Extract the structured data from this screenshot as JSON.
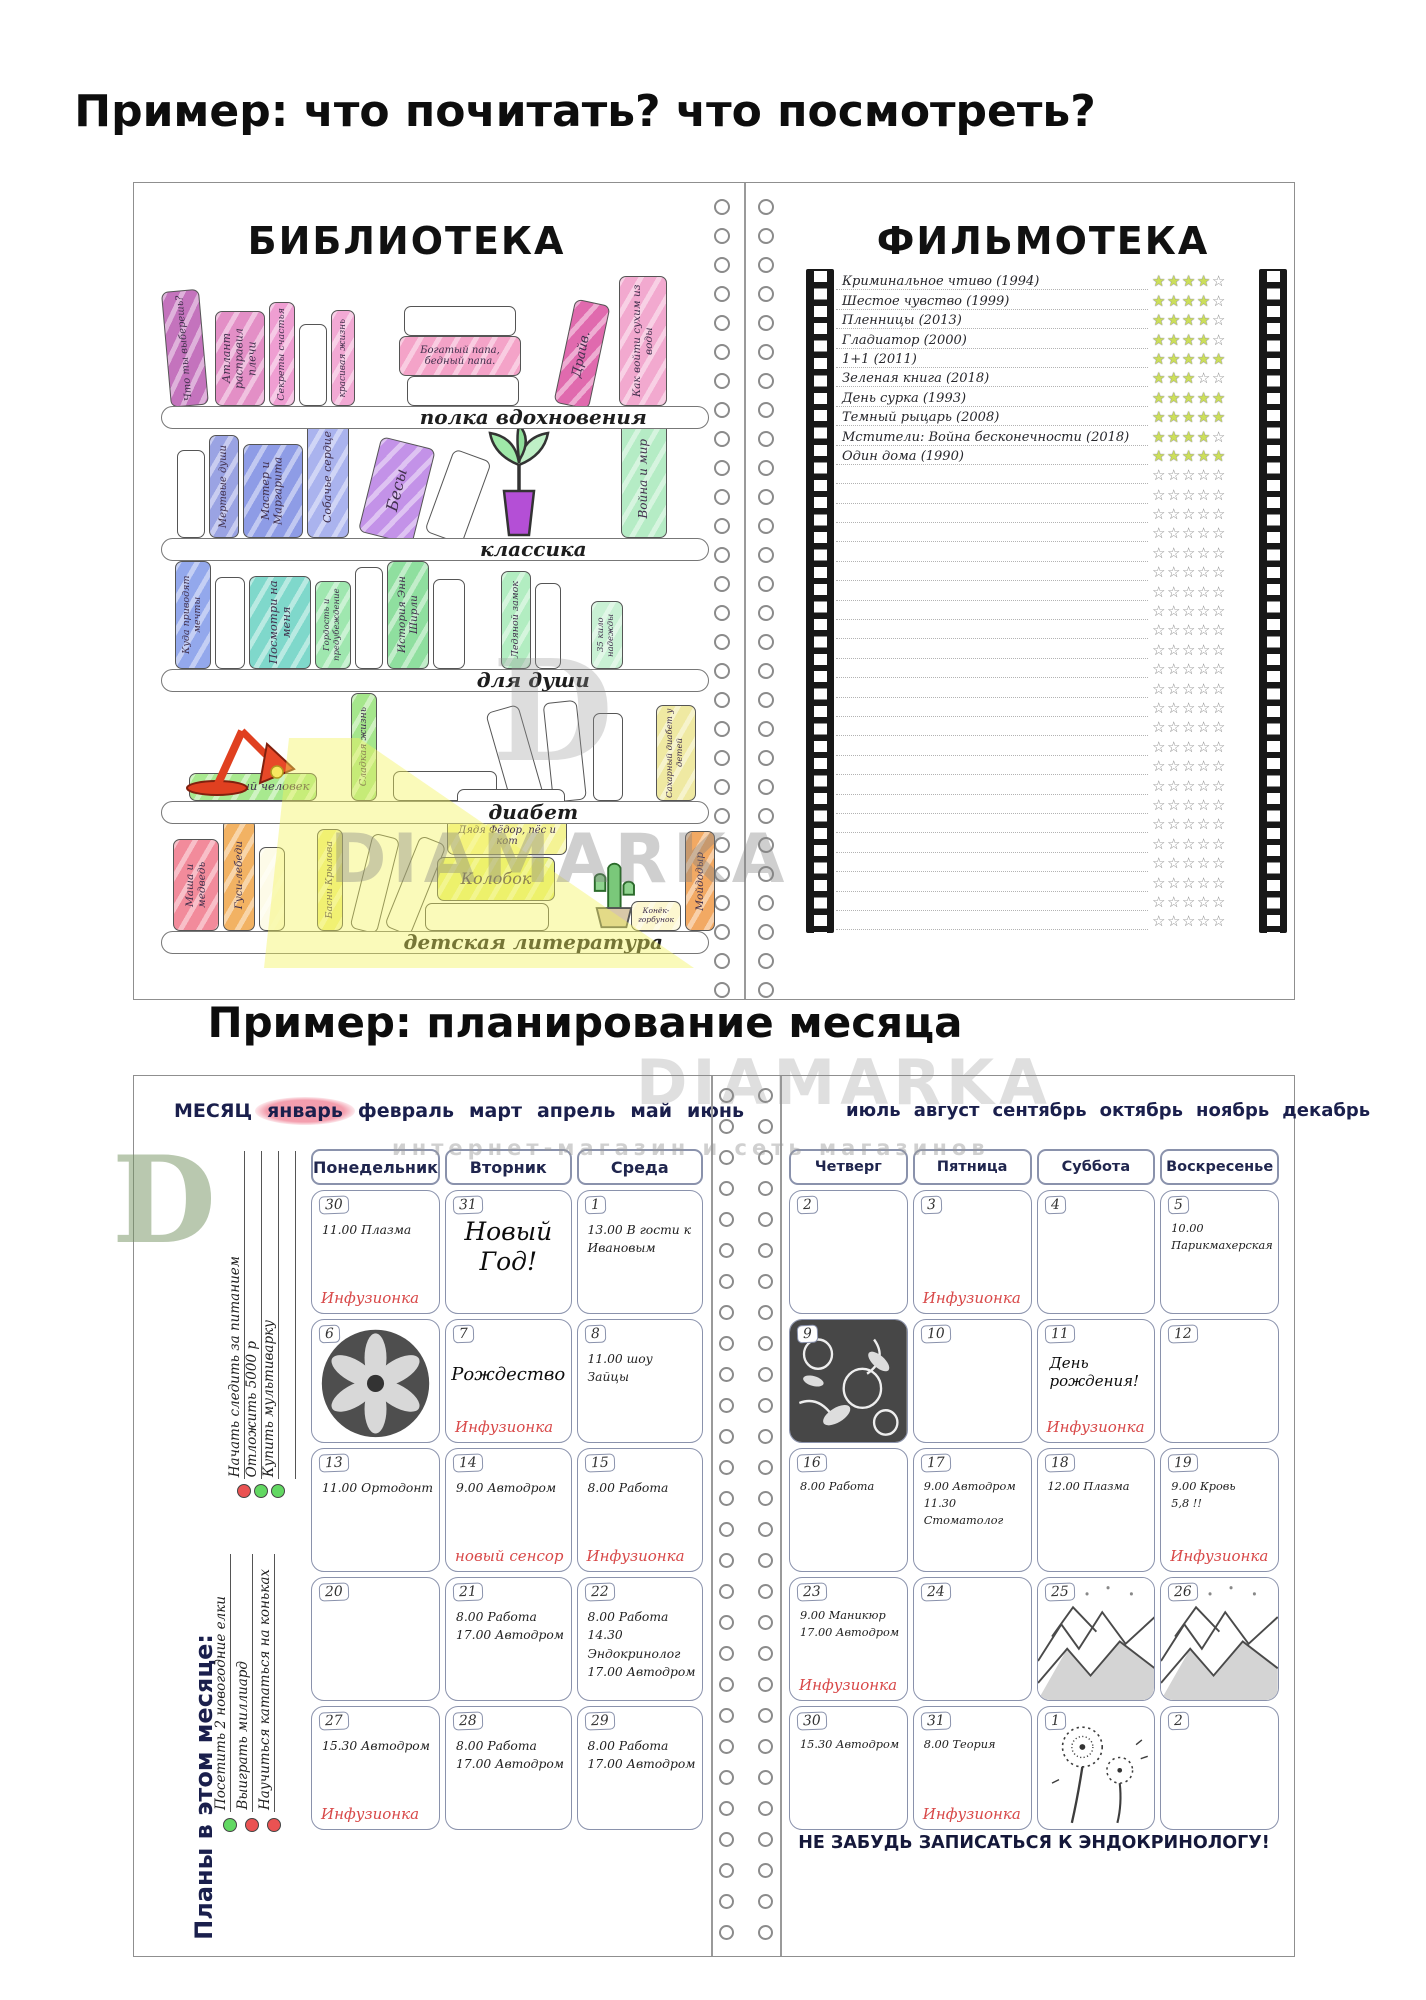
{
  "titles": {
    "top": "Пример: что почитать? что посмотреть?",
    "bottom": "Пример: планирование месяца"
  },
  "watermark": {
    "brand": "DIAMARKA",
    "tagline": "интернет-магазин и сеть магазинов",
    "logo_letter": "D"
  },
  "library": {
    "title": "БИБЛИОТЕКА",
    "shelves": [
      {
        "label": "полка вдохновения",
        "books": [
          {
            "t": "Что ты выберешь?",
            "c": "#c473bd"
          },
          {
            "t": "Атлант расправил плечи",
            "c": "#e38fc6"
          },
          {
            "t": "Секреты счастья",
            "c": "#ef9ed2"
          },
          {
            "t": "",
            "c": "#ffffff"
          },
          {
            "t": "красивая жизнь",
            "c": "#f2a9d4"
          },
          {
            "t": "",
            "c": "#ffffff"
          },
          {
            "t": "Богатый папа, бедный папа.",
            "c": "#f4a3c8"
          },
          {
            "t": "",
            "c": "#ffffff"
          },
          {
            "t": "Драйв.",
            "c": "#e06aae"
          },
          {
            "t": "Как войти сухим из воды",
            "c": "#f2a9cf"
          }
        ]
      },
      {
        "label": "классика",
        "books": [
          {
            "t": "",
            "c": "#ffffff"
          },
          {
            "t": "Мертвые души",
            "c": "#9aa3e3"
          },
          {
            "t": "Мастер и Маргарита",
            "c": "#8e9ce6"
          },
          {
            "t": "Собачье сердце",
            "c": "#aab3ee"
          },
          {
            "t": "Бесы",
            "c": "#c392e8"
          },
          {
            "t": "",
            "c": "#ffffff"
          },
          {
            "t": "Война и мир",
            "c": "#b5ecc5"
          }
        ]
      },
      {
        "label": "для души",
        "books": [
          {
            "t": "Куда приводят мечты",
            "c": "#93a8ec"
          },
          {
            "t": "",
            "c": "#ffffff"
          },
          {
            "t": "Посмотри на меня",
            "c": "#7fd8cb"
          },
          {
            "t": "Гордость и предубеждение",
            "c": "#9fe7af"
          },
          {
            "t": "",
            "c": "#ffffff"
          },
          {
            "t": "История Энн Ширли",
            "c": "#8fdf9f"
          },
          {
            "t": "",
            "c": "#ffffff"
          },
          {
            "t": "Ледяной замок",
            "c": "#b2edc1"
          },
          {
            "t": "",
            "c": "#ffffff"
          },
          {
            "t": "35 кило надежды",
            "c": "#c9f1d4"
          }
        ]
      },
      {
        "label": "диабет",
        "books": [
          {
            "t": "Сахарный человек",
            "c": "#a8e98f"
          },
          {
            "t": "Сладкая жизнь",
            "c": "#a5e68c"
          },
          {
            "t": "",
            "c": "#ffffff"
          },
          {
            "t": "",
            "c": "#ffffff"
          },
          {
            "t": "",
            "c": "#ffffff"
          },
          {
            "t": "",
            "c": "#ffffff"
          },
          {
            "t": "Сахарный диабет у детей",
            "c": "#efe9a2"
          }
        ]
      },
      {
        "label": "детская литература",
        "books": [
          {
            "t": "Маша и медведь",
            "c": "#f28b9b"
          },
          {
            "t": "Гуси-лебеди",
            "c": "#f2b263"
          },
          {
            "t": "",
            "c": "#fdfbe8"
          },
          {
            "t": "Басни Крылова",
            "c": "#eff083"
          },
          {
            "t": "",
            "c": "#ffffff"
          },
          {
            "t": "",
            "c": "#ffffff"
          },
          {
            "t": "",
            "c": "#ffffff"
          },
          {
            "t": "Дядя Фёдор, пёс и кот",
            "c": "#f4f394"
          },
          {
            "t": "Колобок",
            "c": "#e8f078"
          },
          {
            "t": "",
            "c": "#ffffff"
          },
          {
            "t": "Конёк-горбунок",
            "c": "#fdf7d0"
          },
          {
            "t": "Мойдодыр",
            "c": "#f2a963"
          }
        ]
      }
    ]
  },
  "filmoteka": {
    "title": "ФИЛЬМОТЕКА",
    "max_stars": 5,
    "star_color": "#ccdf5a",
    "entries": [
      {
        "title": "Криминальное чтиво (1994)",
        "stars": 4
      },
      {
        "title": "Шестое чувство (1999)",
        "stars": 4
      },
      {
        "title": "Пленницы (2013)",
        "stars": 4
      },
      {
        "title": "Гладиатор (2000)",
        "stars": 4
      },
      {
        "title": "1+1 (2011)",
        "stars": 5
      },
      {
        "title": "Зеленая книга (2018)",
        "stars": 3
      },
      {
        "title": "День сурка (1993)",
        "stars": 5
      },
      {
        "title": "Темный рыцарь (2008)",
        "stars": 5
      },
      {
        "title": "Мстители: Война бесконечности (2018)",
        "stars": 4
      },
      {
        "title": "Один дома (1990)",
        "stars": 5
      }
    ],
    "empty_rows": 24
  },
  "planner": {
    "month_label": "МЕСЯЦ",
    "months_left": [
      "январь",
      "февраль",
      "март",
      "апрель",
      "май",
      "июнь"
    ],
    "months_right": [
      "июль",
      "август",
      "сентябрь",
      "октябрь",
      "ноябрь",
      "декабрь"
    ],
    "selected_month": "январь",
    "highlight_color": "#f294a5",
    "accent_color": "#d84848",
    "bullet_colors": {
      "red": "#ea5252",
      "green": "#62d862"
    },
    "days_left": [
      "Понедельник",
      "Вторник",
      "Среда"
    ],
    "days_right": [
      "Четверг",
      "Пятница",
      "Суббота",
      "Воскресенье"
    ],
    "sidebar": {
      "title": "Планы в этом месяце:",
      "goals_top": [
        {
          "text": "Начать следить за питанием",
          "bullet": "red"
        },
        {
          "text": "Отложить 5000 р",
          "bullet": "green"
        },
        {
          "text": "Купить мультиварку",
          "bullet": "green"
        }
      ],
      "goals_bottom": [
        {
          "text": "Посетить 2 новогодние елки",
          "bullet": "green"
        },
        {
          "text": "Выиграть миллиард",
          "bullet": "red"
        },
        {
          "text": "Научиться кататься на коньках",
          "bullet": "red"
        }
      ]
    },
    "cells_left": [
      [
        {
          "day": "30",
          "events": [
            "11.00 Плазма"
          ],
          "note": "Инфузионка"
        },
        {
          "day": "31",
          "feature": "Новый Год!",
          "fstyle": "xl"
        },
        {
          "day": "1",
          "events": [
            "13.00 В гости к Ивановым"
          ]
        }
      ],
      [
        {
          "day": "6",
          "image": "lily"
        },
        {
          "day": "7",
          "feature": "Рождество",
          "fstyle": "md",
          "note": "Инфузионка"
        },
        {
          "day": "8",
          "events": [
            "11.00 шоу Зайцы"
          ]
        }
      ],
      [
        {
          "day": "13",
          "events": [
            "11.00 Ортодонт"
          ]
        },
        {
          "day": "14",
          "events": [
            "9.00 Автодром"
          ],
          "note": "новый сенсор"
        },
        {
          "day": "15",
          "events": [
            "8.00 Работа"
          ],
          "note": "Инфузионка"
        }
      ],
      [
        {
          "day": "20"
        },
        {
          "day": "21",
          "events": [
            "8.00 Работа",
            "17.00 Автодром"
          ]
        },
        {
          "day": "22",
          "events": [
            "8.00 Работа",
            "14.30 Эндокринолог",
            "17.00 Автодром"
          ]
        }
      ],
      [
        {
          "day": "27",
          "events": [
            "15.30 Автодром"
          ],
          "note": "Инфузионка"
        },
        {
          "day": "28",
          "events": [
            "8.00 Работа",
            "17.00 Автодром"
          ]
        },
        {
          "day": "29",
          "events": [
            "8.00 Работа",
            "17.00 Автодром"
          ]
        }
      ]
    ],
    "cells_right": [
      [
        {
          "day": "2"
        },
        {
          "day": "3",
          "note": "Инфузионка"
        },
        {
          "day": "4"
        },
        {
          "day": "5",
          "events": [
            "10.00 Парикмахерская"
          ]
        }
      ],
      [
        {
          "day": "9",
          "image": "butterflies"
        },
        {
          "day": "10"
        },
        {
          "day": "11",
          "feature": "День рождения!",
          "fstyle": "sm",
          "note": "Инфузионка"
        },
        {
          "day": "12"
        }
      ],
      [
        {
          "day": "16",
          "events": [
            "8.00 Работа"
          ]
        },
        {
          "day": "17",
          "events": [
            "9.00 Автодром",
            "11.30 Стоматолог"
          ]
        },
        {
          "day": "18",
          "events": [
            "12.00 Плазма"
          ]
        },
        {
          "day": "19",
          "events": [
            "9.00 Кровь",
            "5,8 !!"
          ],
          "note": "Инфузионка"
        }
      ],
      [
        {
          "day": "23",
          "events": [
            "9.00 Маникюр",
            "17.00 Автодром"
          ],
          "note": "Инфузионка"
        },
        {
          "day": "24"
        },
        {
          "day": "25",
          "image": "mountains"
        },
        {
          "day": "26",
          "image": "mountains"
        }
      ],
      [
        {
          "day": "30",
          "events": [
            "15.30 Автодром"
          ]
        },
        {
          "day": "31",
          "events": [
            "8.00 Теория"
          ],
          "note": "Инфузионка"
        },
        {
          "day": "1",
          "image": "dandelion"
        },
        {
          "day": "2"
        }
      ]
    ],
    "footer_note": "НЕ ЗАБУДЬ ЗАПИСАТЬСЯ К ЭНДОКРИНОЛОГУ!"
  }
}
